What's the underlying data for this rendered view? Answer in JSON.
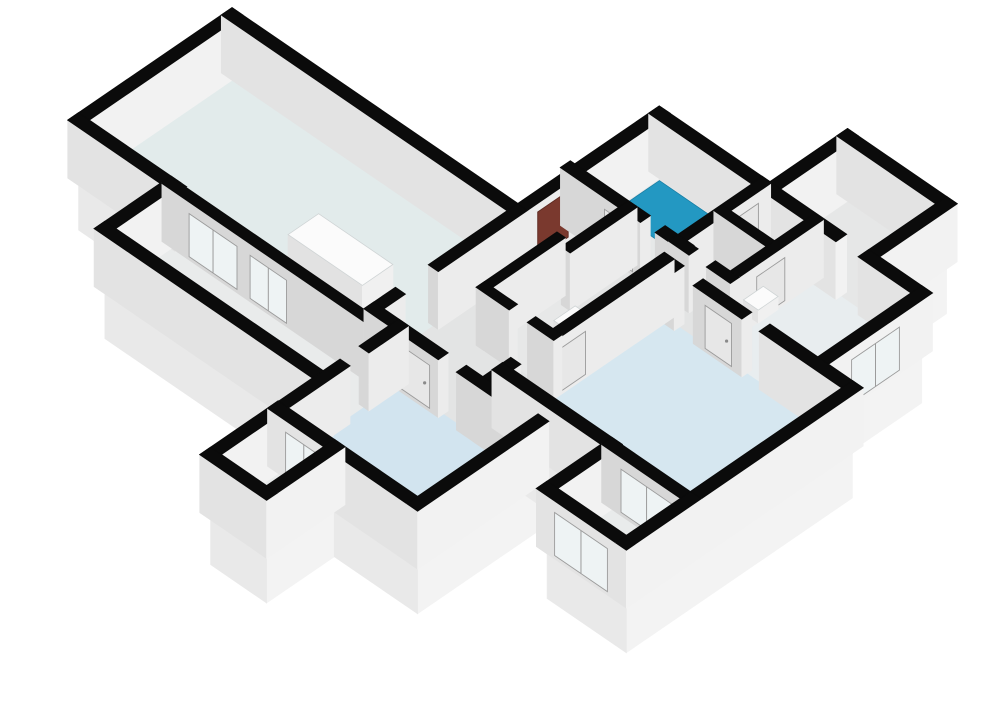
{
  "app": {
    "title": "3D floor plan isometric render",
    "background": "#ffffff"
  },
  "scene": {
    "width": 1000,
    "height": 707,
    "origin": [
      232,
      73
    ],
    "axis_u": [
      0.825,
      0.565
    ],
    "axis_v": [
      -0.825,
      0.565
    ],
    "wall_height": 58,
    "base_depth": 52,
    "colors": {
      "background": "#ffffff",
      "wall_top": "#0b0b0b",
      "ext_face_u": "#f2f2f2",
      "ext_face_v": "#e3e3e3",
      "int_face_u": "#ececec",
      "int_face_v": "#d7d7d7",
      "base_face_u": "#f3f3f3",
      "base_face_v": "#e9e9e9",
      "glass": "#eef3f4",
      "glass_frame": "#9b9b9b",
      "door": "#e7e7e7",
      "door_handle": "#8a8a8a",
      "red_panel": "#7a392e",
      "red_panel_edge": "#5f2b22",
      "fixture_top": "#fbfbfb",
      "fixture_u": "#f0f0f0",
      "fixture_v": "#e2e2e2",
      "shower": "#2398c2"
    }
  },
  "floors": [
    {
      "name": "living-room",
      "rect": [
        0,
        0,
        346,
        186
      ],
      "color": "#e2ebeb"
    },
    {
      "name": "loggia",
      "rect": [
        112,
        186,
        376,
        266
      ],
      "color": "#e9ebeb"
    },
    {
      "name": "hallway",
      "rect": [
        346,
        -70,
        478,
        174
      ],
      "color": "#e3e4e4"
    },
    {
      "name": "hall-link",
      "rect": [
        478,
        -70,
        534,
        -46
      ],
      "color": "#e3e4e4"
    },
    {
      "name": "closet",
      "rect": [
        346,
        -70,
        410,
        0
      ],
      "color": "#dfe0e0"
    },
    {
      "name": "wc",
      "rect": [
        394,
        0,
        478,
        88
      ],
      "color": "#e7e8e8"
    },
    {
      "name": "bathroom",
      "rect": [
        346,
        -172,
        470,
        -70
      ],
      "color": "#e6e8e8"
    },
    {
      "name": "toilet-room",
      "rect": [
        470,
        -172,
        534,
        -70
      ],
      "color": "#e6e8e8"
    },
    {
      "name": "kitchen",
      "rect": [
        534,
        -172,
        664,
        -46
      ],
      "color": "#e8edef"
    },
    {
      "name": "storage-room",
      "rect": [
        480,
        -266,
        600,
        -172
      ],
      "color": "#e6e7e7"
    },
    {
      "name": "bedroom-1",
      "rect": [
        376,
        174,
        545,
        320
      ],
      "color": "#d2e4ef"
    },
    {
      "name": "balcony-1",
      "rect": [
        376,
        320,
        444,
        402
      ],
      "color": "#e9ebeb"
    },
    {
      "name": "bedroom-2",
      "rect": [
        478,
        -46,
        706,
        150
      ],
      "color": "#d6e7f0"
    },
    {
      "name": "balcony-2",
      "rect": [
        610,
        150,
        706,
        228
      ],
      "color": "#e9ebeb"
    }
  ],
  "walls": [
    {
      "a": [
        0,
        0
      ],
      "b": [
        346,
        0
      ],
      "t": 13,
      "type": "ext"
    },
    {
      "a": [
        0,
        0
      ],
      "b": [
        0,
        186
      ],
      "t": 13,
      "type": "ext"
    },
    {
      "a": [
        0,
        186
      ],
      "b": [
        118,
        186
      ],
      "t": 13,
      "type": "ext"
    },
    {
      "a": [
        112,
        186
      ],
      "b": [
        112,
        266
      ],
      "t": 13,
      "type": "ext"
    },
    {
      "a": [
        112,
        266
      ],
      "b": [
        376,
        266
      ],
      "t": 13,
      "type": "ext"
    },
    {
      "a": [
        112,
        186
      ],
      "b": [
        346,
        186
      ],
      "t": 11,
      "type": "int"
    },
    {
      "a": [
        376,
        174
      ],
      "b": [
        376,
        210
      ],
      "t": 12,
      "type": "int"
    },
    {
      "a": [
        376,
        245
      ],
      "b": [
        376,
        320
      ],
      "t": 12,
      "type": "int"
    },
    {
      "a": [
        376,
        320
      ],
      "b": [
        376,
        402
      ],
      "t": 13,
      "type": "ext"
    },
    {
      "a": [
        376,
        402
      ],
      "b": [
        444,
        402
      ],
      "t": 13,
      "type": "ext"
    },
    {
      "a": [
        444,
        320
      ],
      "b": [
        444,
        402
      ],
      "t": 13,
      "type": "ext"
    },
    {
      "a": [
        376,
        320
      ],
      "b": [
        545,
        320
      ],
      "t": 13,
      "type": "ext"
    },
    {
      "a": [
        545,
        174
      ],
      "b": [
        545,
        320
      ],
      "t": 13,
      "type": "ext"
    },
    {
      "a": [
        346,
        174
      ],
      "b": [
        424,
        174
      ],
      "t": 12,
      "type": "int"
    },
    {
      "a": [
        458,
        174
      ],
      "b": [
        545,
        174
      ],
      "t": 12,
      "type": "int"
    },
    {
      "a": [
        346,
        0
      ],
      "b": [
        346,
        96
      ],
      "t": 12,
      "type": "int"
    },
    {
      "a": [
        346,
        148
      ],
      "b": [
        346,
        174
      ],
      "t": 12,
      "type": "int"
    },
    {
      "a": [
        340,
        -70
      ],
      "b": [
        425,
        -70
      ],
      "t": 12,
      "type": "int"
    },
    {
      "a": [
        455,
        -70
      ],
      "b": [
        478,
        -70
      ],
      "t": 12,
      "type": "int"
    },
    {
      "a": [
        410,
        -70
      ],
      "b": [
        410,
        0
      ],
      "t": 11,
      "type": "int"
    },
    {
      "a": [
        346,
        -172
      ],
      "b": [
        346,
        -70
      ],
      "t": 13,
      "type": "ext"
    },
    {
      "a": [
        346,
        -172
      ],
      "b": [
        470,
        -172
      ],
      "t": 13,
      "type": "ext"
    },
    {
      "a": [
        470,
        -172
      ],
      "b": [
        470,
        -70
      ],
      "t": 11,
      "type": "int"
    },
    {
      "a": [
        470,
        -172
      ],
      "b": [
        560,
        -172
      ],
      "t": 13,
      "type": "ext"
    },
    {
      "a": [
        600,
        -172
      ],
      "b": [
        664,
        -172
      ],
      "t": 13,
      "type": "ext"
    },
    {
      "a": [
        470,
        -124
      ],
      "b": [
        534,
        -124
      ],
      "t": 10,
      "type": "int"
    },
    {
      "a": [
        470,
        -70
      ],
      "b": [
        484,
        -70
      ],
      "t": 11,
      "type": "int"
    },
    {
      "a": [
        516,
        -70
      ],
      "b": [
        534,
        -70
      ],
      "t": 11,
      "type": "int"
    },
    {
      "a": [
        534,
        -172
      ],
      "b": [
        534,
        -68
      ],
      "t": 11,
      "type": "int"
    },
    {
      "a": [
        664,
        -172
      ],
      "b": [
        664,
        -46
      ],
      "t": 13,
      "type": "ext"
    },
    {
      "a": [
        480,
        -266
      ],
      "b": [
        600,
        -266
      ],
      "t": 13,
      "type": "ext"
    },
    {
      "a": [
        480,
        -266
      ],
      "b": [
        480,
        -172
      ],
      "t": 13,
      "type": "ext"
    },
    {
      "a": [
        600,
        -266
      ],
      "b": [
        600,
        -172
      ],
      "t": 13,
      "type": "ext"
    },
    {
      "a": [
        478,
        -46
      ],
      "b": [
        490,
        -46
      ],
      "t": 12,
      "type": "int"
    },
    {
      "a": [
        525,
        -46
      ],
      "b": [
        572,
        -46
      ],
      "t": 12,
      "type": "int"
    },
    {
      "a": [
        606,
        -46
      ],
      "b": [
        706,
        -46
      ],
      "t": 13,
      "type": "ext"
    },
    {
      "a": [
        478,
        -46
      ],
      "b": [
        478,
        100
      ],
      "t": 12,
      "type": "int"
    },
    {
      "a": [
        478,
        140
      ],
      "b": [
        478,
        174
      ],
      "t": 12,
      "type": "int"
    },
    {
      "a": [
        706,
        -46
      ],
      "b": [
        706,
        150
      ],
      "t": 13,
      "type": "ext"
    },
    {
      "a": [
        478,
        150
      ],
      "b": [
        610,
        150
      ],
      "t": 13,
      "type": "ext"
    },
    {
      "a": [
        610,
        150
      ],
      "b": [
        706,
        150
      ],
      "t": 12,
      "type": "int"
    },
    {
      "a": [
        610,
        150
      ],
      "b": [
        610,
        228
      ],
      "t": 13,
      "type": "ext"
    },
    {
      "a": [
        610,
        228
      ],
      "b": [
        706,
        228
      ],
      "t": 13,
      "type": "ext"
    },
    {
      "a": [
        706,
        150
      ],
      "b": [
        706,
        228
      ],
      "t": 13,
      "type": "ext"
    },
    {
      "a": [
        394,
        0
      ],
      "b": [
        394,
        88
      ],
      "t": 10,
      "type": "int"
    },
    {
      "a": [
        394,
        88
      ],
      "b": [
        424,
        88
      ],
      "t": 10,
      "type": "int"
    },
    {
      "a": [
        456,
        88
      ],
      "b": [
        478,
        88
      ],
      "t": 10,
      "type": "int"
    },
    {
      "a": [
        346,
        -70
      ],
      "b": [
        346,
        0
      ],
      "t": 12,
      "type": "int"
    }
  ],
  "panels": [
    {
      "wall": 5,
      "side": "v",
      "from": 140,
      "to": 198,
      "kind": "glass",
      "name": "french-doors-living-loggia-1"
    },
    {
      "wall": 5,
      "side": "v",
      "from": 214,
      "to": 258,
      "kind": "glass",
      "name": "french-doors-living-loggia-2"
    },
    {
      "wall": 11,
      "side": "v",
      "from": 392,
      "to": 436,
      "kind": "glass",
      "name": "balcony-1-glazed-door"
    },
    {
      "wall": 40,
      "side": "v",
      "from": 628,
      "to": 690,
      "kind": "glass",
      "name": "balcony-2-french-doors"
    },
    {
      "wall": 42,
      "side": "v",
      "from": 626,
      "to": 690,
      "kind": "glass",
      "name": "balcony-2-window"
    },
    {
      "wall": 29,
      "side": "u",
      "from": -138,
      "to": -80,
      "kind": "glass",
      "name": "kitchen-window"
    },
    {
      "wall": 47,
      "side": "u",
      "from": -55,
      "to": -18,
      "kind": "red",
      "name": "utility-cabinet-panel"
    },
    {
      "wall": 36,
      "side": "u",
      "from": 56,
      "to": 96,
      "kind": "door",
      "name": "bedroom-2-door"
    },
    {
      "wall": 34,
      "side": "v",
      "from": 534,
      "to": 566,
      "kind": "door",
      "name": "kitchen-door"
    },
    {
      "wall": 17,
      "side": "v",
      "from": 388,
      "to": 422,
      "kind": "door",
      "name": "bathroom-door"
    },
    {
      "wall": 13,
      "side": "v",
      "from": 384,
      "to": 420,
      "kind": "door",
      "name": "bedroom-1-door"
    },
    {
      "wall": 28,
      "side": "u",
      "from": -130,
      "to": -96,
      "kind": "door",
      "name": "kitchen-inner-door"
    },
    {
      "wall": 22,
      "side": "u",
      "from": -162,
      "to": -130,
      "kind": "door",
      "name": "toilet-room-door"
    }
  ],
  "bases": {
    "east": [
      [
        600,
        -266,
        -172
      ],
      [
        664,
        -172,
        -46
      ],
      [
        706,
        -46,
        150
      ],
      [
        706,
        150,
        228
      ],
      [
        545,
        174,
        320
      ],
      [
        444,
        320,
        402
      ]
    ],
    "south": [
      [
        0,
        112,
        186
      ],
      [
        112,
        376,
        266
      ],
      [
        376,
        444,
        402
      ],
      [
        444,
        545,
        320
      ],
      [
        478,
        610,
        150
      ],
      [
        610,
        706,
        228
      ]
    ]
  },
  "fixtures": [
    {
      "name": "shower-tray",
      "kind": "flat",
      "rect": [
        356,
        -162,
        424,
        -108
      ],
      "z": 2,
      "color": "shower"
    },
    {
      "name": "kitchen-counter",
      "kind": "box",
      "rect": [
        200,
        95,
        290,
        132
      ],
      "z": [
        0,
        26
      ]
    },
    {
      "name": "toilet",
      "kind": "box",
      "rect": [
        430,
        14,
        452,
        40
      ],
      "z": [
        0,
        18
      ]
    },
    {
      "name": "wall-sink",
      "kind": "box",
      "rect": [
        540,
        -104,
        558,
        -80
      ],
      "z": [
        20,
        33
      ]
    }
  ]
}
